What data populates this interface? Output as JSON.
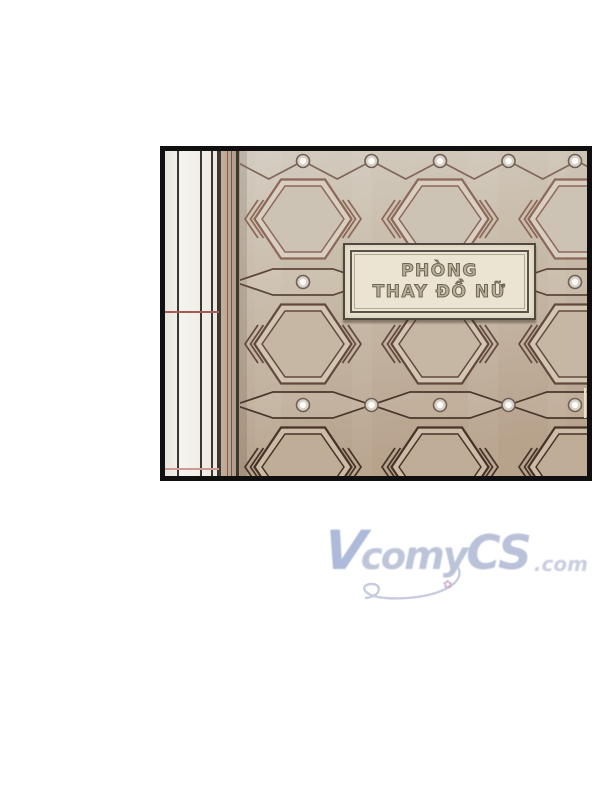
{
  "page": {
    "background": "#ffffff"
  },
  "panel": {
    "border_color": "#101010",
    "marble_column": {
      "base_color": "#f1efe9",
      "vein_color": "#3b3630",
      "v_lines": [
        {
          "x": 12,
          "w": 1.5
        },
        {
          "x": 35,
          "w": 2
        },
        {
          "x": 46,
          "w": 1.5
        },
        {
          "x": 51.5,
          "w": 2.5
        }
      ],
      "h_lines": [
        {
          "y": 160,
          "color": "#a55c52",
          "h": 2
        },
        {
          "y": 317,
          "color": "#cf9a93",
          "h": 1.5
        }
      ]
    },
    "trim_strip": {
      "base_color": "#b3a08c",
      "v_lines": [
        {
          "x": 0,
          "w": 2,
          "color": "#45392f"
        },
        {
          "x": 8,
          "w": 1,
          "color": "#9c5148"
        },
        {
          "x": 11.5,
          "w": 1.5,
          "color": "#6b5a50"
        },
        {
          "x": 17,
          "w": 2.5,
          "color": "#41362f"
        }
      ]
    },
    "wall": {
      "gradient": [
        "#d3ccc0",
        "#cabead",
        "#c1b19e",
        "#b7a28c"
      ],
      "columns": [
        303,
        440,
        577
      ],
      "midpoints": [
        234.5,
        371.5,
        508.5
      ],
      "dot_xs": [
        303,
        371.5,
        440,
        508.5,
        575
      ],
      "hex": {
        "half_w": 48.5,
        "half_h": 39.5,
        "top_half": 22,
        "inner_half_w": 41,
        "inner_half_h": 33,
        "inner_top_half": 18
      },
      "lens": {
        "half_len": 68.5,
        "half_h": 13,
        "flat_half": 30
      },
      "hex_rows": [
        {
          "y": 219,
          "stroke": "#8d6758",
          "frame_fill": "#d8cfc2",
          "inner_fill": "#cdc3b5"
        },
        {
          "y": 344,
          "stroke": "#63493c",
          "frame_fill": "#d2c5b2",
          "inner_fill": "#c6b7a4"
        },
        {
          "y": 467,
          "stroke": "#473327",
          "frame_fill": "#ccbba6",
          "inner_fill": "#bfad97"
        }
      ],
      "bands": [
        {
          "y": 161,
          "type": "zigzag",
          "valley_y": 179,
          "stroke": "#82685c"
        },
        {
          "y": 282,
          "type": "lens",
          "stroke": "#5c463a"
        },
        {
          "y": 405,
          "type": "lens",
          "stroke": "#49372c"
        }
      ],
      "dot": {
        "outer_fill": "#d7d1c7",
        "ring": "#6f6156",
        "inner_fill": "#fdfcf9"
      },
      "highlight_line": {
        "x": 584,
        "y": 388,
        "w": 2.4,
        "h": 30,
        "color": "#eadfc7"
      }
    },
    "sign": {
      "line1": "PHÒNG",
      "line2": "THAY ĐỒ NỮ",
      "bg_color": "#ebe4d2",
      "frame_color": "#5a5448"
    }
  },
  "watermark": {
    "text": "VCOMYCS.com",
    "v": "V",
    "co": "co",
    "my": "my",
    "cs": "CS",
    "suffix": ".com",
    "color": "#bcc3d8",
    "flower_glyph": "✿"
  }
}
